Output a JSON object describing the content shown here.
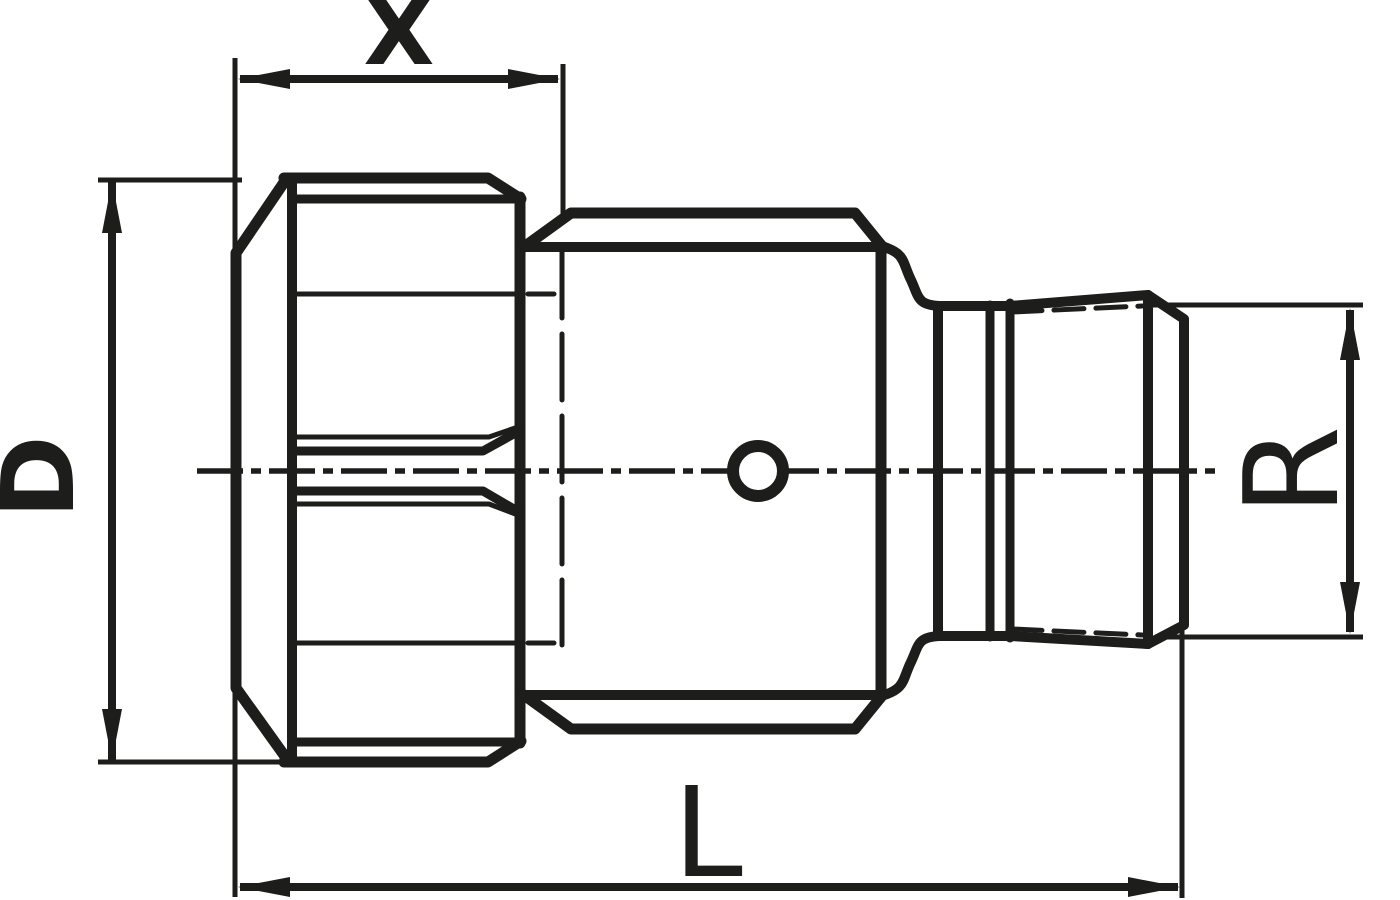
{
  "drawing": {
    "title": "threaded-fitting-dimension-drawing",
    "colors": {
      "ink": "#1d1d1b",
      "background": "#ffffff"
    },
    "dimensions": {
      "x": {
        "label": "X"
      },
      "d": {
        "label": "D"
      },
      "l": {
        "label": "L"
      },
      "r": {
        "label": "R"
      }
    }
  }
}
